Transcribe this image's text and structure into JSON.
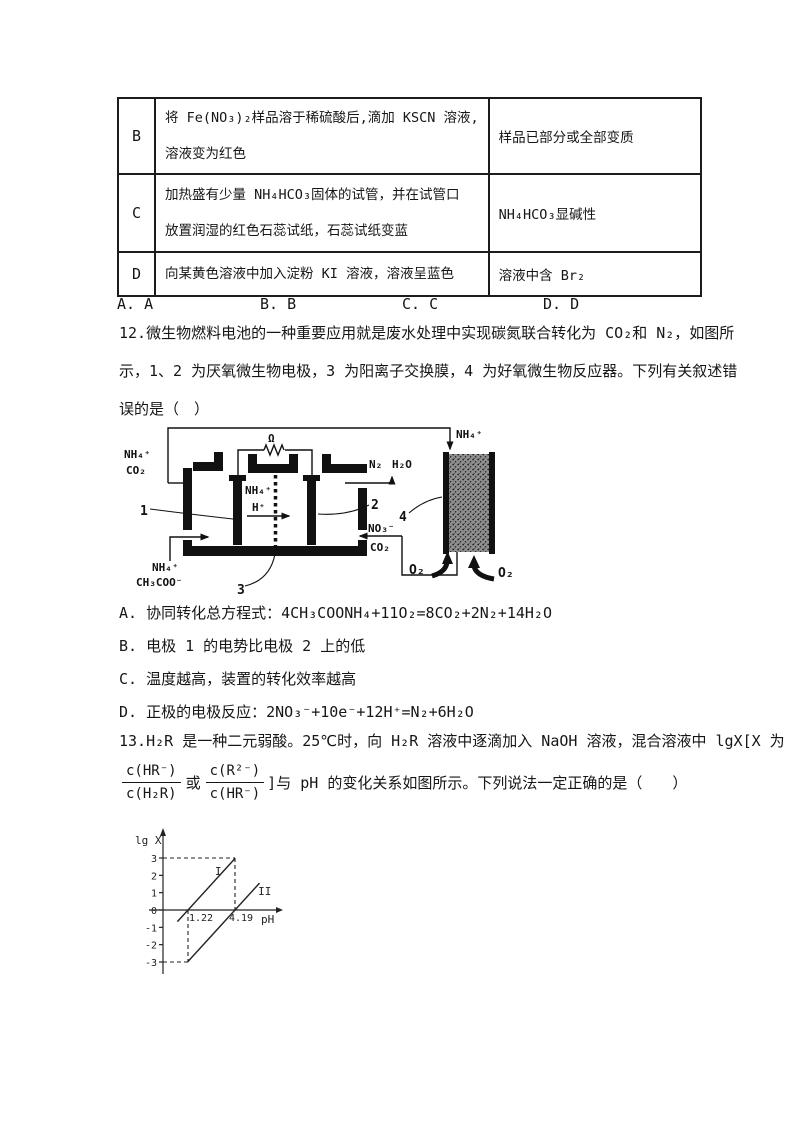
{
  "table": {
    "rows": [
      {
        "label": "B",
        "phenomenon": [
          "将 Fe(NO₃)₂样品溶于稀硫酸后,滴加 KSCN 溶液,",
          "溶液变为红色"
        ],
        "conclusion": "样品已部分或全部变质"
      },
      {
        "label": "C",
        "phenomenon": [
          "加热盛有少量 NH₄HCO₃固体的试管，并在试管口",
          "放置润湿的红色石蕊试纸，石蕊试纸变蓝"
        ],
        "conclusion": "NH₄HCO₃显碱性"
      },
      {
        "label": "D",
        "phenomenon": [
          "向某黄色溶液中加入淀粉 KI 溶液，溶液呈蓝色"
        ],
        "conclusion": "溶液中含 Br₂"
      }
    ]
  },
  "answers": [
    "A. A",
    "B. B",
    "C. C",
    "D. D"
  ],
  "q12": {
    "lines": [
      "12.微生物燃料电池的一种重要应用就是废水处理中实现碳氮联合转化为 CO₂和 N₂，如图所",
      "示，1、2 为厌氧微生物电极，3 为阳离子交换膜，4 为好氧微生物反应器。下列有关叙述错",
      "误的是（　）"
    ],
    "options": [
      {
        "label": "A.",
        "text": "协同转化总方程式：4CH₃COONH₄+11O₂=8CO₂+2N₂+14H₂O"
      },
      {
        "label": "B.",
        "text": "电极 1 的电势比电极 2 上的低"
      },
      {
        "label": "C.",
        "text": "温度越高，装置的转化效率越高"
      },
      {
        "label": "D.",
        "text": "正极的电极反应：2NO₃⁻+10e⁻+12H⁺=N₂+6H₂O"
      }
    ]
  },
  "diagram": {
    "feed_top": [
      "NH₄⁺",
      "CO₂"
    ],
    "reactor_in": "NH₄⁺",
    "resistor": "Ω",
    "mid_ions": [
      "NH₄⁺",
      "H⁺"
    ],
    "out_gas": [
      "N₂",
      "H₂O"
    ],
    "recycle_ions": [
      "NO₃⁻",
      "CO₂"
    ],
    "feed_bottom": [
      "NH₄⁺",
      "CH₃COO⁻"
    ],
    "o2": [
      "O₂",
      "O₂"
    ],
    "parts": {
      "electrode_left": "1",
      "electrode_right": "2",
      "membrane": "3",
      "reactor": "4"
    }
  },
  "q13": {
    "line1": "13.H₂R 是一种二元弱酸。25℃时，向 H₂R 溶液中逐滴加入 NaOH 溶液，混合溶液中 lgX[X 为",
    "frac1": {
      "num": "c(HR⁻)",
      "den": "c(H₂R)"
    },
    "middle": "或",
    "frac2": {
      "num": "c(R²⁻)",
      "den": "c(HR⁻)"
    },
    "tail": "]与 pH 的变化关系如图所示。下列说法一定正确的是（　　）"
  },
  "chart_data": {
    "type": "line",
    "title": "",
    "xlabel": "pH",
    "ylabel": "lg X",
    "xlim": [
      0,
      6.5
    ],
    "ylim": [
      -3.5,
      4
    ],
    "grid": false,
    "yticks": [
      3,
      2,
      1,
      0,
      -1,
      -2,
      -3
    ],
    "x_value_labels": [
      {
        "x": 1.22,
        "text": "1.22"
      },
      {
        "x": 4.19,
        "text": "4.19"
      }
    ],
    "series": [
      {
        "name": "I",
        "slope": 1,
        "x_intercept": 1.22,
        "points": [
          [
            0.55,
            -0.67
          ],
          [
            4.19,
            2.97
          ]
        ],
        "label_pos": [
          2.93,
          2.02
        ]
      },
      {
        "name": "II",
        "slope": 1,
        "x_intercept": 4.19,
        "points": [
          [
            1.19,
            -3.0
          ],
          [
            5.74,
            1.55
          ]
        ],
        "label_pos": [
          5.65,
          0.87
        ]
      }
    ],
    "dashed_guides": [
      {
        "from": [
          0,
          3
        ],
        "to": [
          4.19,
          3
        ]
      },
      {
        "from": [
          4.19,
          3
        ],
        "to": [
          4.19,
          0
        ]
      },
      {
        "from": [
          1.22,
          0
        ],
        "to": [
          1.22,
          -3
        ]
      },
      {
        "from": [
          0,
          -3
        ],
        "to": [
          1.22,
          -3
        ]
      }
    ]
  }
}
